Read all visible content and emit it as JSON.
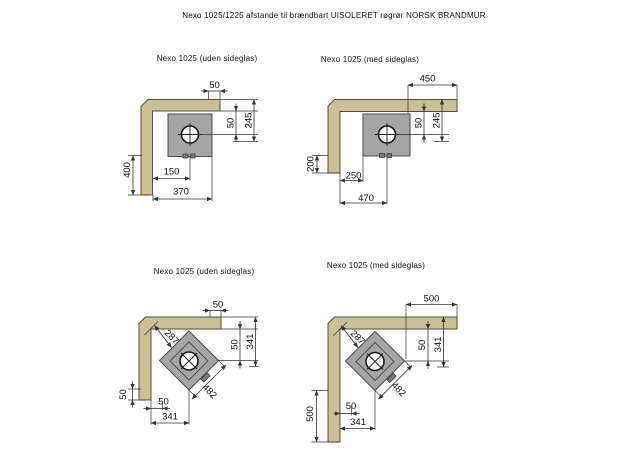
{
  "page_title": "Nexo 1025/1225 afstande til brændbart UISOLERET røgrør NORSK BRANDMUR",
  "colors": {
    "wall": "#cbbf97",
    "wall_border": "#55503f",
    "stove": "#a5a5a5",
    "stove_border": "#4a4a4a",
    "line": "#333333",
    "text": "#111111",
    "background": "#ffffff"
  },
  "diagrams": [
    {
      "title": "Nexo 1025 (uden sideglas)",
      "orientation": "straight",
      "dims": {
        "top": "50",
        "right_inner": "50",
        "right_outer": "245",
        "left": "400",
        "bottom_inner": "150",
        "bottom_outer": "370"
      }
    },
    {
      "title": "Nexo 1025 (med sideglas)",
      "orientation": "straight",
      "dims": {
        "top": "450",
        "right_inner": "50",
        "right_outer": "245",
        "left": "200",
        "bottom_inner": "250",
        "bottom_outer": "470"
      }
    },
    {
      "title": "Nexo 1025 (uden sideglas)",
      "orientation": "corner-45",
      "dims": {
        "top": "50",
        "right_inner": "50",
        "right_outer": "341",
        "left": "50",
        "bottom_inner": "50",
        "bottom_outer": "341",
        "diag_front": "287",
        "diag_width": "482"
      }
    },
    {
      "title": "Nexo 1025 (med sideglas)",
      "orientation": "corner-45",
      "dims": {
        "top": "500",
        "right_inner": "50",
        "right_outer": "341",
        "left": "500",
        "bottom_inner": "50",
        "bottom_outer": "341",
        "diag_front": "287",
        "diag_width": "482"
      }
    }
  ]
}
